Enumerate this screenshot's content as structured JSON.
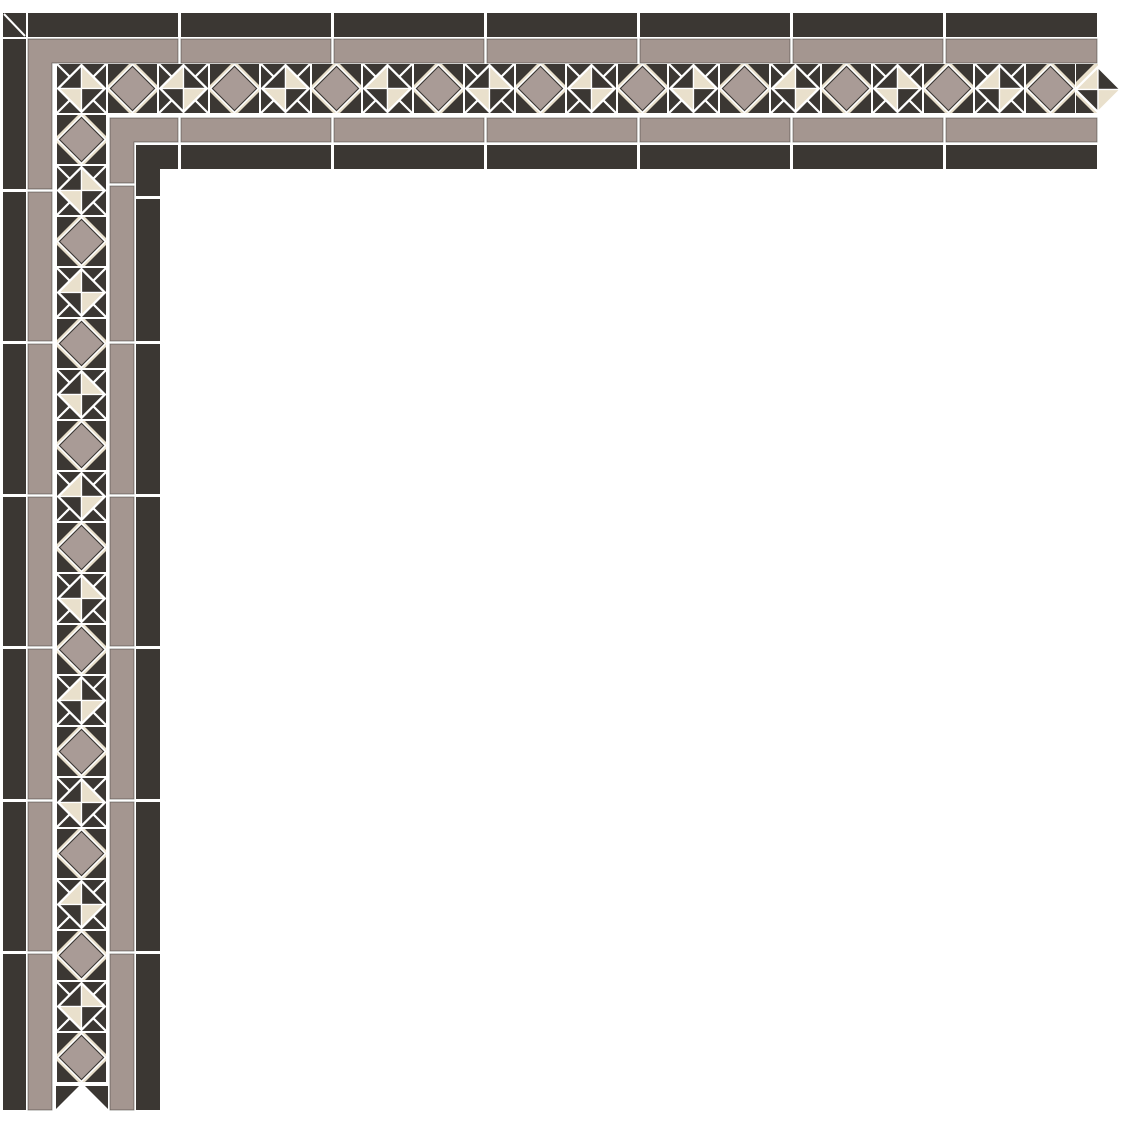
{
  "canvas": {
    "width": 1123,
    "height": 1123,
    "background_color": "#ffffff"
  },
  "artwork_title": "victorian-geometric-tile-border-corner",
  "palette": {
    "dark": "#3b3733",
    "grey": "#a49690",
    "cream": "#e9e0cc",
    "diamond_grey": "#a99b96",
    "gap": "#ffffff"
  },
  "corner_square": {
    "x": 3,
    "y": 13,
    "w": 23,
    "h": 24,
    "diagonal": "tl-br"
  },
  "strips": [
    {
      "name": "outer-dark-strip-horizontal",
      "color": "dark",
      "y": 13,
      "h": 24,
      "tiles_x": [
        [
          28,
          178
        ],
        [
          181,
          331
        ],
        [
          334,
          484
        ],
        [
          487,
          637
        ],
        [
          640,
          790
        ],
        [
          793,
          943
        ],
        [
          946,
          1097
        ]
      ]
    },
    {
      "name": "outer-grey-strip-horizontal",
      "color": "grey",
      "y": 39,
      "h": 24,
      "tiles_x": [
        [
          181,
          331
        ],
        [
          334,
          484
        ],
        [
          487,
          637
        ],
        [
          640,
          790
        ],
        [
          793,
          943
        ],
        [
          946,
          1097
        ]
      ]
    },
    {
      "name": "inner-grey-strip-horizontal",
      "color": "grey",
      "y": 118,
      "h": 24,
      "tiles_x": [
        [
          181,
          331
        ],
        [
          334,
          484
        ],
        [
          487,
          637
        ],
        [
          640,
          790
        ],
        [
          793,
          943
        ],
        [
          946,
          1097
        ]
      ]
    },
    {
      "name": "inner-dark-strip-horizontal",
      "color": "dark",
      "y": 145,
      "h": 24,
      "tiles_x": [
        [
          181,
          331
        ],
        [
          334,
          484
        ],
        [
          487,
          637
        ],
        [
          640,
          790
        ],
        [
          793,
          943
        ],
        [
          946,
          1097
        ]
      ]
    },
    {
      "name": "outer-dark-strip-vertical",
      "color": "dark",
      "x": 3,
      "w": 23,
      "tiles_y": [
        [
          39,
          189
        ],
        [
          192,
          341
        ],
        [
          344,
          494
        ],
        [
          497,
          646
        ],
        [
          649,
          799
        ],
        [
          802,
          951
        ],
        [
          954,
          1110
        ]
      ]
    },
    {
      "name": "outer-grey-strip-vertical",
      "color": "grey",
      "x": 28,
      "w": 24,
      "tiles_y": [
        [
          192,
          341
        ],
        [
          344,
          494
        ],
        [
          497,
          646
        ],
        [
          649,
          799
        ],
        [
          802,
          951
        ],
        [
          954,
          1110
        ]
      ]
    },
    {
      "name": "inner-grey-strip-vertical",
      "color": "grey",
      "x": 110,
      "w": 24,
      "tiles_y": [
        [
          186,
          341
        ],
        [
          344,
          494
        ],
        [
          497,
          646
        ],
        [
          649,
          799
        ],
        [
          802,
          951
        ],
        [
          954,
          1110
        ]
      ]
    },
    {
      "name": "inner-dark-strip-vertical",
      "color": "dark",
      "x": 136,
      "w": 24,
      "tiles_y": [
        [
          199,
          341
        ],
        [
          344,
          494
        ],
        [
          497,
          646
        ],
        [
          649,
          799
        ],
        [
          802,
          951
        ],
        [
          954,
          1110
        ]
      ]
    }
  ],
  "corner_l_pieces": [
    {
      "name": "outer-grey-corner-l",
      "color": "grey",
      "h_arm": {
        "x": 28,
        "y": 39,
        "w": 150,
        "h": 24
      },
      "v_arm": {
        "x": 28,
        "y": 39,
        "w": 24,
        "h": 150
      }
    },
    {
      "name": "inner-grey-corner-l",
      "color": "grey",
      "h_arm": {
        "x": 110,
        "y": 118,
        "w": 68,
        "h": 24
      },
      "v_arm": {
        "x": 110,
        "y": 118,
        "w": 24,
        "h": 65
      }
    },
    {
      "name": "inner-dark-corner-l",
      "color": "dark",
      "h_arm": {
        "x": 136,
        "y": 145,
        "w": 42,
        "h": 24
      },
      "v_arm": {
        "x": 136,
        "y": 145,
        "w": 24,
        "h": 51
      }
    }
  ],
  "motif_band": {
    "tile_size": 51,
    "corner_tile": {
      "x": 56,
      "y": 63,
      "type": "pinwheel-b"
    },
    "horizontal_run": {
      "start_x": 107,
      "y": 63,
      "sequence": [
        "diamond",
        "pinwheel-a",
        "diamond",
        "pinwheel-b",
        "diamond",
        "pinwheel-a",
        "diamond",
        "pinwheel-b",
        "diamond",
        "pinwheel-a",
        "diamond",
        "pinwheel-b",
        "diamond",
        "pinwheel-a",
        "diamond",
        "pinwheel-b",
        "diamond",
        "pinwheel-a",
        "diamond"
      ]
    },
    "vertical_run": {
      "x": 56,
      "start_y": 114,
      "sequence": [
        "diamond",
        "pinwheel-b",
        "diamond",
        "pinwheel-a",
        "diamond",
        "pinwheel-b",
        "diamond",
        "pinwheel-a",
        "diamond",
        "pinwheel-b",
        "diamond",
        "pinwheel-a",
        "diamond",
        "pinwheel-b",
        "diamond",
        "pinwheel-a",
        "diamond",
        "pinwheel-b",
        "diamond"
      ]
    },
    "end_cap_right": {
      "x": 1076,
      "y": 63,
      "style": "pointed-checkered-diamond",
      "quadrants": [
        "cream",
        "dark",
        "dark",
        "cream"
      ]
    },
    "end_cap_bottom": {
      "x": 56,
      "y": 1086,
      "style": "cut-notch"
    }
  },
  "motif_styles": {
    "diamond": {
      "field": "cream",
      "corner_triangle_leg": 21,
      "fill": "diamond_grey",
      "outline": "dark"
    },
    "pinwheel-a": {
      "field": "dark",
      "quadrants": [
        "cream",
        "dark",
        "dark",
        "cream"
      ]
    },
    "pinwheel-b": {
      "field": "dark",
      "quadrants": [
        "dark",
        "cream",
        "cream",
        "dark"
      ]
    }
  }
}
